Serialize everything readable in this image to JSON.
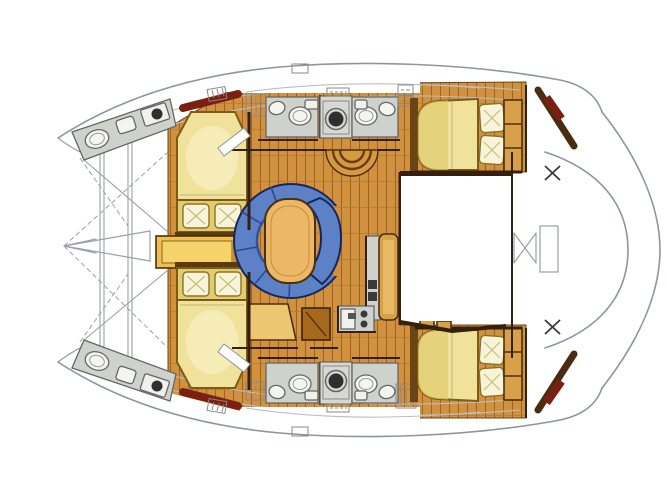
{
  "plan": {
    "subject": "catamaran-interior-floor-plan",
    "view": "top-down",
    "depicted_elements": [
      "port-hull",
      "starboard-hull",
      "bow-trampoline",
      "center-nacelle-bow",
      "forward-cabin-double-bed-port",
      "forward-cabin-double-bed-starboard",
      "forward-vanity-desk",
      "bow-toilet-and-sink-port",
      "bow-toilet-and-sink-starboard",
      "salon-u-shaped-sofa",
      "salon-table",
      "curved-companionway-steps",
      "nav-seat",
      "storage-locker",
      "galley-counter-with-sink-and-stove",
      "galley-tall-cabinet",
      "head-compartment-toilet",
      "head-compartment-sink",
      "washing-machine",
      "companionway-steps",
      "illegible-label-plates",
      "aft-cabin-double-bed-port",
      "aft-cabin-double-bed-starboard",
      "bed-pillows",
      "wardrobe-shelves",
      "cockpit-well",
      "transom-platform",
      "cockpit-table-outline",
      "stern-cross-marks",
      "coachroof-window-bands",
      "deck-hatches"
    ]
  },
  "colors": {
    "background": "#ffffff",
    "wood": "#d2913f",
    "wood_plank": "#9c6423",
    "bed": "#f1e29b",
    "bed_shade": "#e3cc6f",
    "pillow": "#f8f4da",
    "desk": "#efc04f",
    "desk_light": "#f6d36a",
    "desk_shadow": "#c98f2e",
    "sofa": "#5d81c7",
    "sofa_inner": "#31519f",
    "table": "#edb76a",
    "counter": "#cfd2cc",
    "fixture": "#f4f4f0",
    "appliance_unit": "#d8d8d2",
    "appliance_face": "#f0f0ec",
    "drum": "#2f2f2f",
    "cabinet": "#d9a04a",
    "cabinet_light": "#e7b965",
    "seat": "#ecc670",
    "locker": "#a8681c",
    "maroon": "#7a2012",
    "steps_fill": "#d49a42",
    "steps_line": "#6b3a16",
    "trim": "#35200d",
    "headboard": "#5a3a12",
    "white": "#ffffff",
    "dark_knob": "#3a3a3a"
  }
}
